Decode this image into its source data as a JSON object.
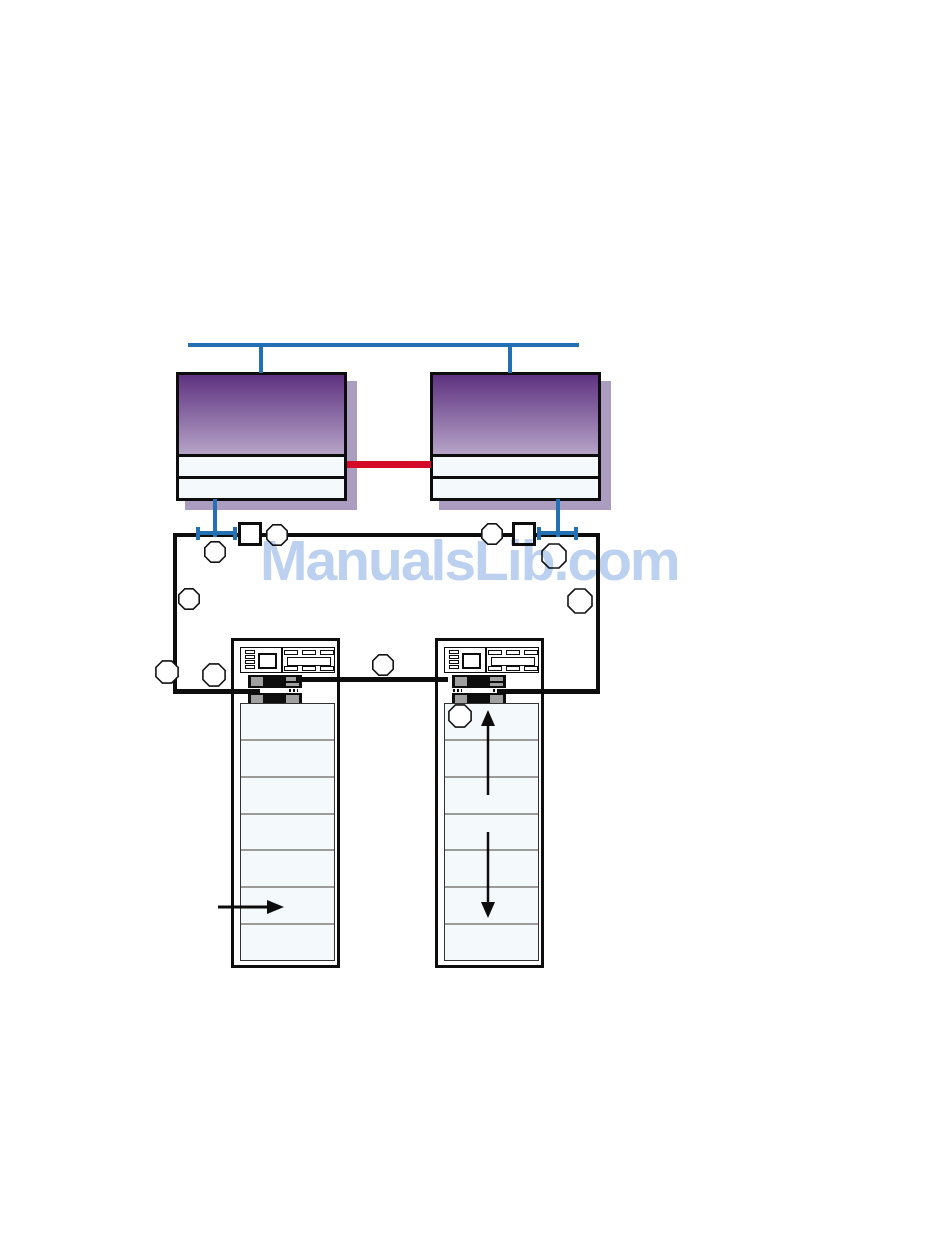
{
  "watermark": {
    "text": "ManualsLib.com"
  },
  "figure": {
    "kind": "server-cluster-storage-diagram",
    "counts": {
      "server_nodes": 2,
      "storage_racks": 2,
      "shelves_per_rack": 7,
      "callout_circles": 10,
      "port_squares": 2,
      "flow_arrows": 3
    },
    "colors": {
      "network-blue": "#2470b4",
      "interconnect-red": "#d40a28",
      "server-purple-top": "#5e3280",
      "server-purple-bottom": "#b5a3c7",
      "drop-shadow": "#ab9dc0",
      "panel-fill": "#f4fafc",
      "line-black": "#0d0d0d",
      "row-separator": "#9b9b9b",
      "module-gray": "#a0a0a0",
      "watermark-blue": "#bcd0f0"
    }
  }
}
